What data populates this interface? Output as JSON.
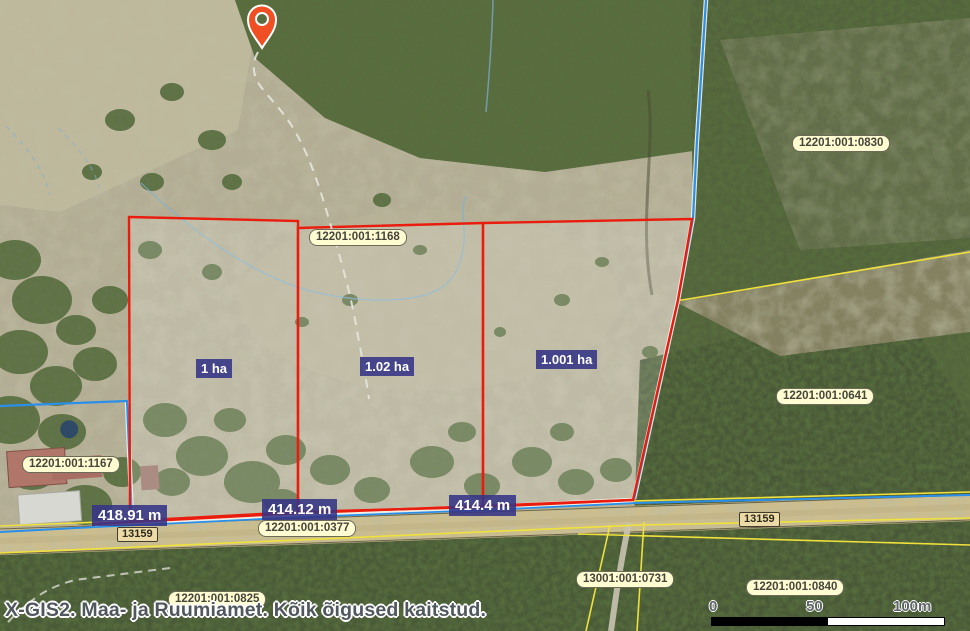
{
  "app": {
    "footer_credit": "X-GIS2. Maa- ja Ruumiamet. Kõik õigused kaitstud."
  },
  "map": {
    "marker": "location-pin",
    "cadastral": {
      "c0830": "12201:001:0830",
      "c1168": "12201:001:1168",
      "c0641": "12201:001:0641",
      "c1167": "12201:001:1167",
      "c0377": "12201:001:0377",
      "c0825": "12201:001:0825",
      "c0731": "13001:001:0731",
      "c0840": "12201:001:0840"
    },
    "road_numbers": {
      "left": "13159",
      "right": "13159"
    },
    "parcel_areas": {
      "p1": "1 ha",
      "p2": "1.02 ha",
      "p3": "1.001 ha"
    },
    "measurements": {
      "m1": "418.91 m",
      "m2": "414.12 m",
      "m3": "414.4 m"
    },
    "scale_bar": {
      "tick0": "0",
      "tick50": "50",
      "tick100": "100m"
    },
    "colors": {
      "parcel_outline_red": "#ea1c0d",
      "boundary_blue": "#2a8fe8",
      "cadastral_yellow": "#f0e13d",
      "pill_background": "#fffcd2",
      "measure_background": "#343486",
      "marker_orange": "#f04e23"
    }
  }
}
